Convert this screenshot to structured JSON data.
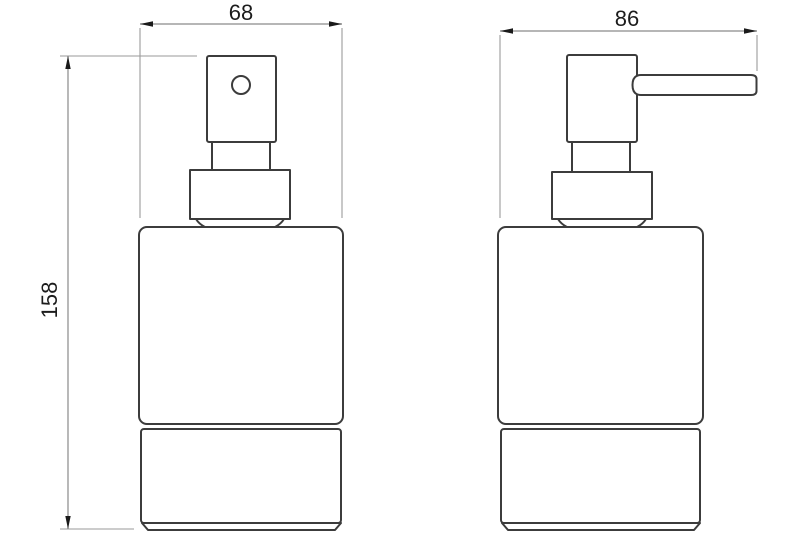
{
  "drawing": {
    "type": "technical-dimension-drawing",
    "subject": "soap-dispenser",
    "views": [
      {
        "name": "front-view",
        "width_dimension": "68",
        "height_dimension": "158"
      },
      {
        "name": "side-view",
        "width_dimension": "86"
      }
    ],
    "dimensions": [
      {
        "name": "front-width",
        "value": "68",
        "orientation": "horizontal"
      },
      {
        "name": "side-width",
        "value": "86",
        "orientation": "horizontal"
      },
      {
        "name": "overall-height",
        "value": "158",
        "orientation": "vertical"
      }
    ],
    "colors": {
      "background": "#ffffff",
      "outline": "#3c3c3c",
      "dimension_line": "#8a8a8a",
      "arrow": "#1a1a1a",
      "label_text": "#1c1c1c"
    }
  }
}
